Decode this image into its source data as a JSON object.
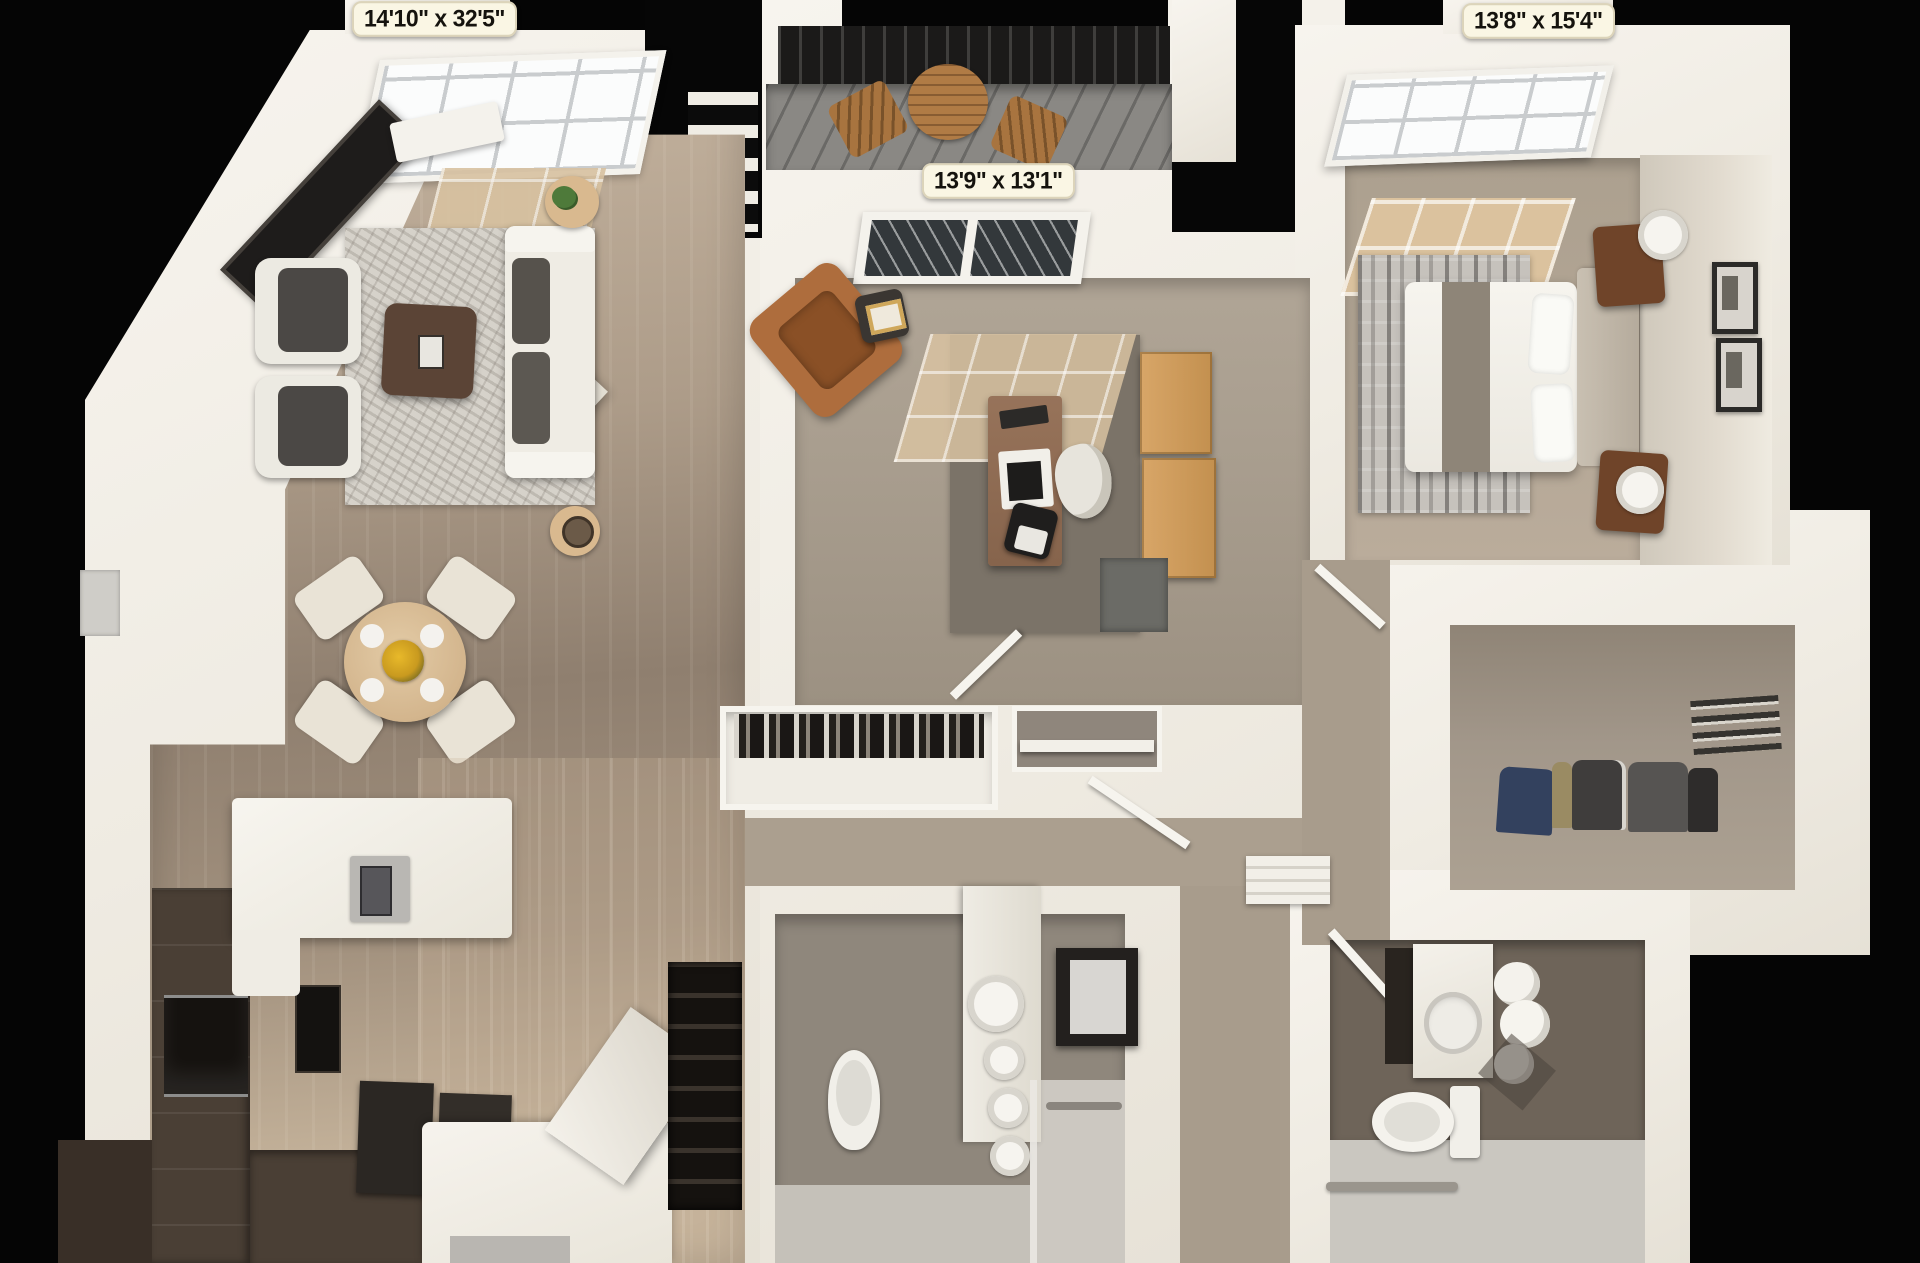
{
  "rooms": {
    "living_room": {
      "dimensions": "14'10\" x 32'5\""
    },
    "den": {
      "dimensions": "13'9\" x 13'1\""
    },
    "bedroom": {
      "dimensions": "13'8\" x 15'4\""
    }
  },
  "colors": {
    "background": "#050505",
    "wall_white": "#f2efe8",
    "floor_wood_living": "#a3927f",
    "floor_kitchen": "#c6b49c",
    "floor_office": "#a89d8e",
    "floor_bedroom": "#b3a695",
    "floor_patio": "#8a8884",
    "floor_bath_dark": "#6e6459",
    "floor_bath_light": "#cac7c0",
    "sunlight_patch": "#d8c2a1",
    "cabinet_dark_brown": "#473d33",
    "wood_accent": "#b07b45",
    "storage_cabinet_tan": "#cf9a5e",
    "leather_chair": "#ae6d3d",
    "label_background": "#faf6e4",
    "label_text": "#15130e"
  }
}
